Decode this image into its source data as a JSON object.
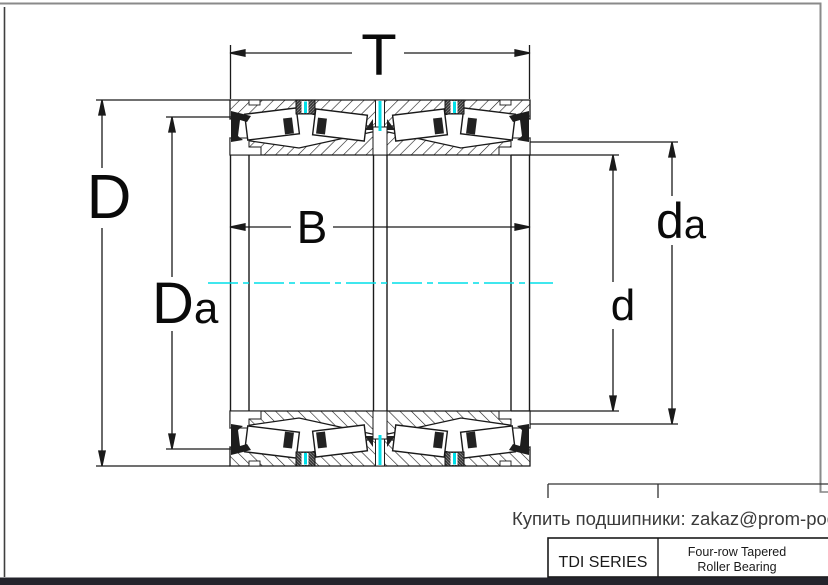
{
  "drawing": {
    "dimension_labels": {
      "overall_width": "T",
      "outer_diameter": "D",
      "housing_abutment_diameter": {
        "base": "D",
        "sub": "a"
      },
      "inner_ring_width": "B",
      "bore_diameter": "d",
      "shaft_abutment_diameter": {
        "base": "d",
        "sub": "a"
      }
    },
    "colors": {
      "centerline": "#00dfe9",
      "seal_tick": "#00dfe9",
      "footer_bar": "#24242c"
    }
  },
  "footer": {
    "purchase_note": "Купить подшипники: zakaz@prom-pod.ru"
  },
  "title_block": {
    "series": "TDI SERIES",
    "bearing_type_line1": "Four-row Tapered",
    "bearing_type_line2": "Roller Bearing"
  }
}
